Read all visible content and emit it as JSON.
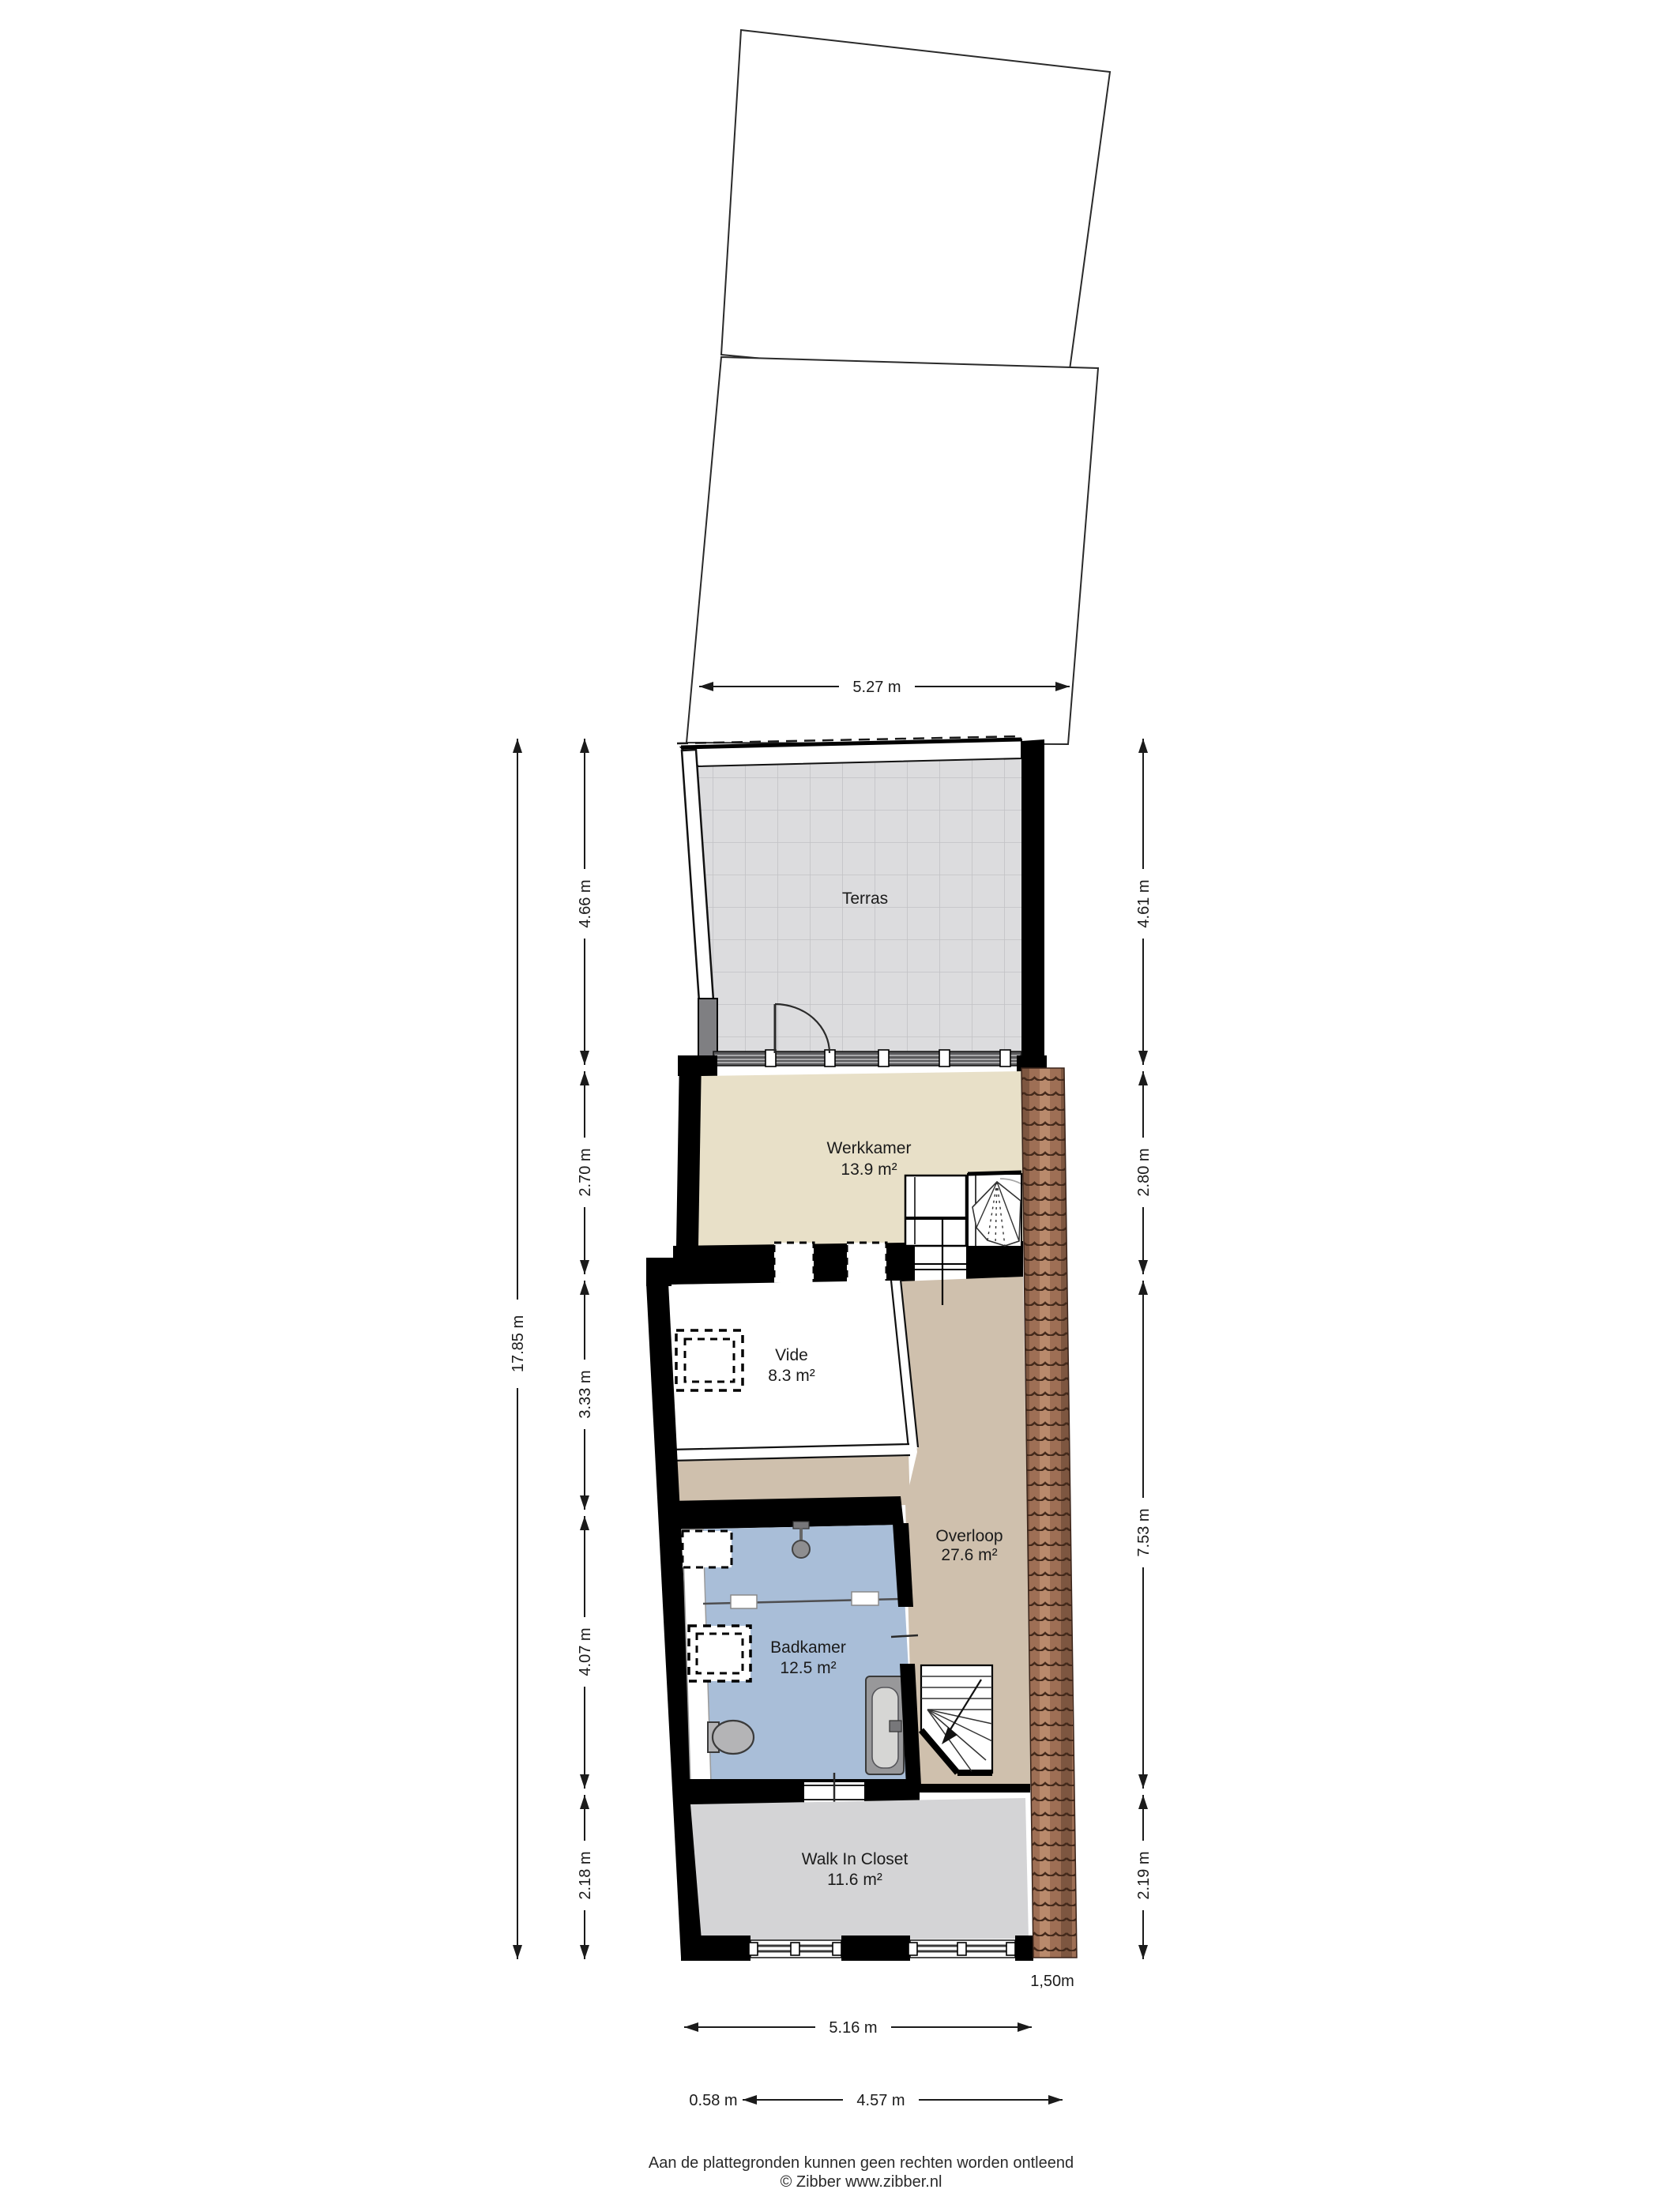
{
  "plan": {
    "title": "Floor plan - second floor (Zibber)",
    "rooms": [
      {
        "id": "terras",
        "name": "Terras",
        "area": ""
      },
      {
        "id": "werkkamer",
        "name": "Werkkamer",
        "area": "13.9 m²"
      },
      {
        "id": "vide",
        "name": "Vide",
        "area": "8.3 m²"
      },
      {
        "id": "overloop",
        "name": "Overloop",
        "area": "27.6 m²"
      },
      {
        "id": "badkamer",
        "name": "Badkamer",
        "area": "12.5 m²"
      },
      {
        "id": "walk_in_closet",
        "name": "Walk In Closet",
        "area": "11.6 m²"
      }
    ],
    "dimensions": {
      "top_width": "5.27 m",
      "left_total": "17.85 m",
      "left_segments": [
        "4.66 m",
        "2.70 m",
        "3.33 m",
        "4.07 m",
        "2.18 m"
      ],
      "right_segments": [
        "4.61 m",
        "2.80 m",
        "7.53 m",
        "2.19 m"
      ],
      "bottom_width": "5.16 m",
      "bottom_left_offset": "0.58 m",
      "bottom_inner_width": "4.57 m",
      "roof_edge_width": "1,50m"
    },
    "footer": {
      "line1": "Aan de plattegronden kunnen geen rechten worden ontleend",
      "line2": "© Zibber www.zibber.nl"
    },
    "colors": {
      "terras_floor": "#dcdcde",
      "terras_grid": "#c2c2c5",
      "werkkamer_floor": "#e8e0c8",
      "vide_floor": "#ffffff",
      "overloop_floor": "#cfc0ad",
      "badkamer_floor": "#a9bed8",
      "closet_floor": "#d4d4d6",
      "roof_tile": "#9e6f55",
      "roof_tile_dark": "#43291b",
      "wall": "#000000"
    }
  }
}
